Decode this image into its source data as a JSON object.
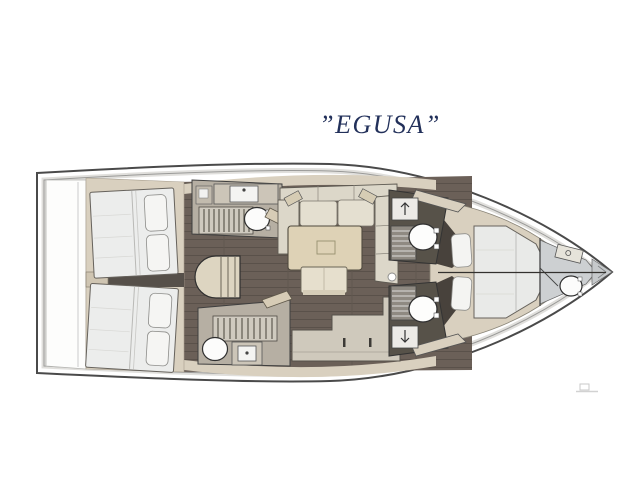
{
  "title": {
    "text": "”EGUSA”",
    "color": "#22305a"
  },
  "plan": {
    "name": "yacht-interior-deck-plan",
    "colors": {
      "hull_line": "#4a4a4a",
      "inner_rail_line": "#9a9a98",
      "floor_wood": "#6b6058",
      "floor_plank_line": "#5a514a",
      "cabinetry": "#d9d0bf",
      "head_wall": "#b6afa3",
      "mattress": "#ecedec",
      "sofa": "#dcd7c9",
      "table": "#ded2b6",
      "fixture_white": "#fcfcfb",
      "bulkhead_dark": "#48423c",
      "bow_compartment": "#cdd0d2"
    },
    "features": [
      {
        "name": "stern-transom-platform"
      },
      {
        "name": "aft-cabin-port-double-bed"
      },
      {
        "name": "aft-cabin-starboard-double-bed"
      },
      {
        "name": "aft-head-port"
      },
      {
        "name": "aft-head-starboard"
      },
      {
        "name": "companionway-steps"
      },
      {
        "name": "saloon-u-sofa"
      },
      {
        "name": "saloon-table"
      },
      {
        "name": "saloon-bench"
      },
      {
        "name": "galley-counter"
      },
      {
        "name": "mid-head-port"
      },
      {
        "name": "mid-head-starboard"
      },
      {
        "name": "mast-post"
      },
      {
        "name": "forward-cabin-island-bed"
      },
      {
        "name": "bow-head"
      },
      {
        "name": "bow-anchor-locker"
      }
    ]
  }
}
